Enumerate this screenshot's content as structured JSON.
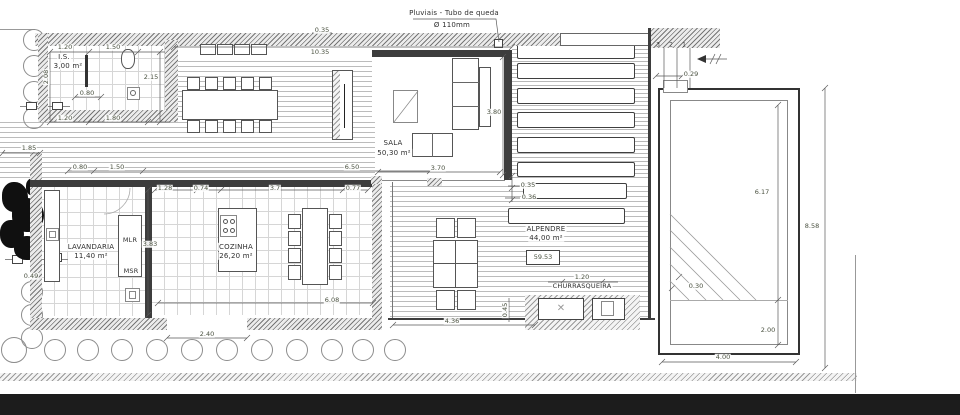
{
  "note": {
    "line1": "Pluviais - Tubo de queda",
    "line2": "Ø 110mm"
  },
  "rooms": {
    "is": {
      "name": "I.S.",
      "area": "3,00 m²"
    },
    "sala": {
      "name": "SALA",
      "area": "50,30 m²"
    },
    "lavandaria": {
      "name": "LAVANDARIA",
      "area": "11,40 m²"
    },
    "cozinha": {
      "name": "COZINHA",
      "area": "26,20 m²"
    },
    "alpendre": {
      "name": "ALPENDRE",
      "area": "44,00 m²"
    },
    "churrasqueira": {
      "name": "CHURRASQUEIRA"
    }
  },
  "appliances": {
    "mlr": "MLR",
    "msr": "MSR"
  },
  "level_marker": "59.53",
  "steps": {
    "n3": "3",
    "n2": "2",
    "n1": "1"
  },
  "icons": {
    "grill": "✕"
  },
  "dims": {
    "is_top_a": "1.20",
    "is_top_b": "1.50",
    "is_left": "2.08",
    "is_inner": "0.80",
    "is_mid": "2.15",
    "is_bot_a": "1.20",
    "is_bot_b": "1.80",
    "wall_thickness": "0.35",
    "top_width": "10.35",
    "left_offset": "1.85",
    "row_a": "0.80",
    "row_b": "1.50",
    "row_c": "6.50",
    "sala_width": "3.70",
    "sala_depth": "3.80",
    "kit_a": "1.28",
    "kit_b": "0.74",
    "kit_c": "3.7",
    "kit_d": "0.77",
    "lav_depth": "3.83",
    "kit_width": "6.08",
    "gate_width": "2.40",
    "alp_a": "0.35",
    "alp_b": "0.36",
    "alp_width": "4.36",
    "alp_side": "0.45",
    "churras_width": "1.20",
    "step_width": "0.29",
    "pool_length": "6.17",
    "pool_step": "0.30",
    "pool_shallow": "2.00",
    "pool_width": "4.00",
    "site_depth": "8.58",
    "bush": "0.49"
  }
}
